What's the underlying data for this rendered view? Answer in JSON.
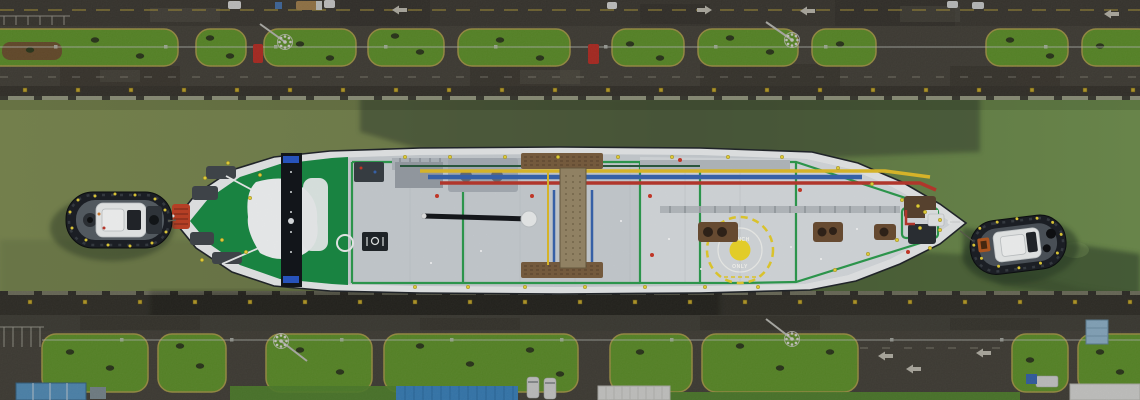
{
  "scene": {
    "type": "aerial-photograph",
    "subject": "Top-down aerial view of a tanker ship transiting a Panama Canal lock chamber, escorted by tugboats at bow and stern",
    "view": "top-down",
    "inventory": {
      "tanker": 1,
      "tugboats": 2,
      "lock_walls": 2,
      "floodlight_towers": 4,
      "grass_islands_top": 10,
      "grass_islands_bottom": 8,
      "vehicles_top_road": 7,
      "red_cars": 2,
      "blue_roof_structures": 3,
      "white_tents": 2,
      "white_vans_bottom": 2
    }
  },
  "ship": {
    "deck_marking": {
      "label_top": "WINCH",
      "label_bottom": "ONLY"
    }
  },
  "palette": {
    "water_left": "#7a8752",
    "water_right": "#6f8d4f",
    "water_mid_shadow": "#3d4836",
    "water_dark_shadow": "#3f5534",
    "wall_asphalt": "#4a463c",
    "wall_dark": "#35332b",
    "road": "#403d35",
    "concrete_lip": "#8e927b",
    "grass": "#67a12c",
    "grass_dark": "#2f3c1c",
    "curb": "#b7a94e",
    "bollard_yellow": "#d7b62c",
    "hull_white": "#e9ebec",
    "deck_gray": "#cbd0d5",
    "deck_light": "#d9dde0",
    "bow_green": "#1b8c46",
    "walkway_green": "#2f9e50",
    "superstructure_white": "#f3f5f6",
    "mast_black": "#14171c",
    "accent_blue": "#2a59c8",
    "pipe_yellow": "#e4bf2c",
    "pipe_blue": "#3a67b2",
    "pipe_red": "#bc3a2e",
    "platform_brown": "#7c6042",
    "winch_brown": "#6d4f35",
    "helipad_yellow": "#f2da2c",
    "helipad_text": "#fdfdf8",
    "tug_hull": "#1d2127",
    "tug_deck": "#585f66",
    "tug_house": "#eceeee",
    "vehicle_red": "#cc2f26",
    "roof_blue": "#3e8fd2",
    "container_blue": "#5b9fd0",
    "roof_lightblue": "#9fc6e0",
    "tent_white": "#ececea",
    "vehicle_white": "#e8e8e6",
    "truck_tan": "#b08a52",
    "marking_white": "#cfccc0",
    "bow_winch_red": "#c24428"
  }
}
